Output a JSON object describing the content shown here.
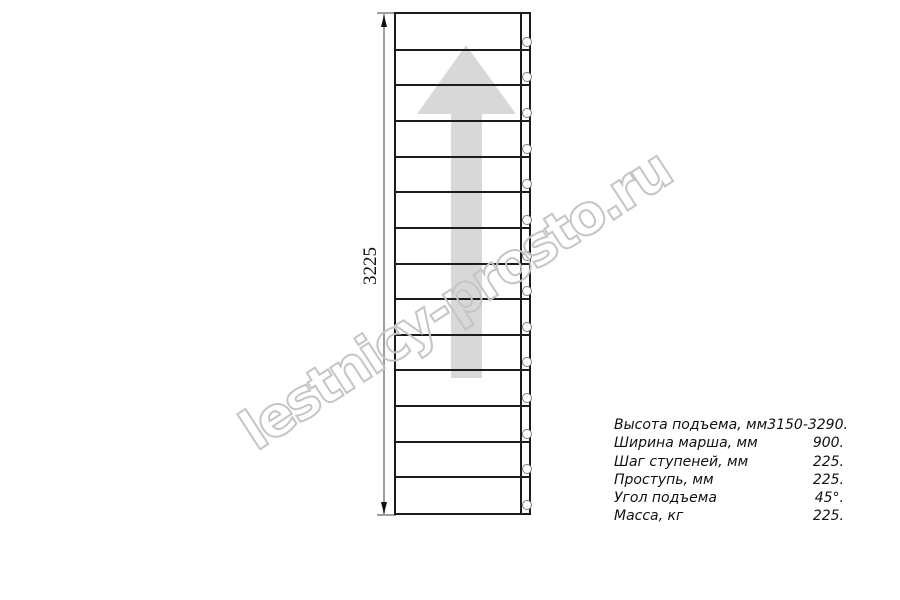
{
  "drawing": {
    "type": "staircase-plan-top-view",
    "steps_count": 14,
    "screws_count": 14,
    "direction_arrow": "up",
    "dimension": {
      "label": "3225"
    },
    "colors": {
      "outline": "#1c1c1c",
      "dimension_line": "#9e9e9e",
      "arrow_fill": "#d8d8d8",
      "screw_outline": "#7d7d7d"
    }
  },
  "watermark": {
    "text": "lestnicy-prosto.ru",
    "color": "#c5c5c5"
  },
  "specs": {
    "rows": [
      {
        "label": "Высота подъема, мм",
        "value": "3150-3290."
      },
      {
        "label": "Ширина марша, мм",
        "value": "900."
      },
      {
        "label": "Шаг ступеней, мм",
        "value": "225."
      },
      {
        "label": "Проступь, мм",
        "value": "225."
      },
      {
        "label": "Угол подъема",
        "value": "45°."
      },
      {
        "label": "Масса, кг",
        "value": "225."
      }
    ]
  }
}
